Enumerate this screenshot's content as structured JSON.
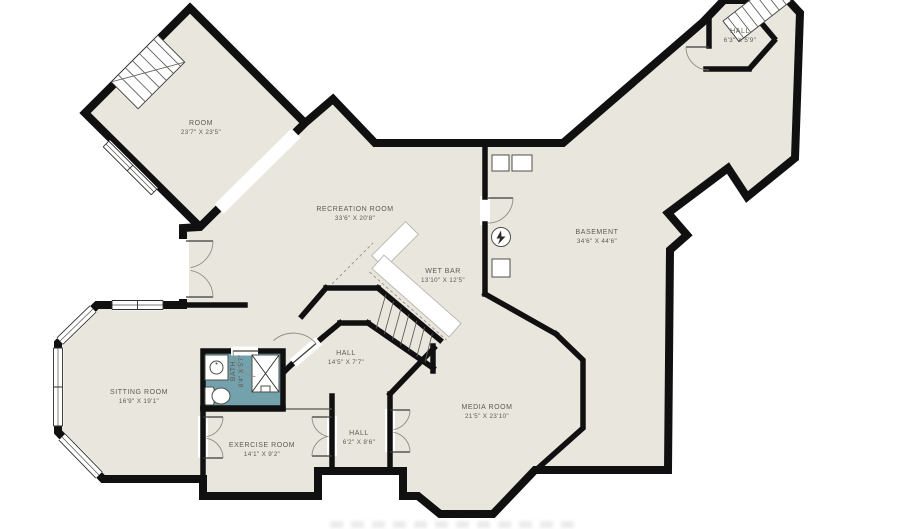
{
  "floorplan": {
    "title": "Basement floor plan",
    "rooms": [
      {
        "name": "ROOM",
        "dims": "23'7\" X 23'5\""
      },
      {
        "name": "RECREATION ROOM",
        "dims": "33'6\" X 20'8\""
      },
      {
        "name": "BASEMENT",
        "dims": "34'6\" X 44'6\""
      },
      {
        "name": "HALL",
        "dims": "6'3\" X 5'9\""
      },
      {
        "name": "WET BAR",
        "dims": "13'10\" X 12'5\""
      },
      {
        "name": "HALL",
        "dims": "14'5\" X 7'7\""
      },
      {
        "name": "SITTING ROOM",
        "dims": "16'9\" X 19'1\""
      },
      {
        "name": "BATH",
        "dims": "8'4\" X 5'7\""
      },
      {
        "name": "EXERCISE ROOM",
        "dims": "14'1\" X 9'2\""
      },
      {
        "name": "HALL",
        "dims": "6'2\" X 8'6\""
      },
      {
        "name": "MEDIA ROOM",
        "dims": "21'5\" X 23'10\""
      }
    ],
    "colors": {
      "background": "#ffffff",
      "floor": "#e8e6dd",
      "wall": "#101010",
      "bath": "#73a2ad",
      "label": "#5c5c55"
    },
    "icons": [
      "stairs-icon",
      "door-arc-icon",
      "window-icon",
      "electrical-panel-icon",
      "appliance-icon",
      "sink-icon",
      "toilet-icon",
      "shower-icon",
      "wet-bar-counter"
    ]
  }
}
